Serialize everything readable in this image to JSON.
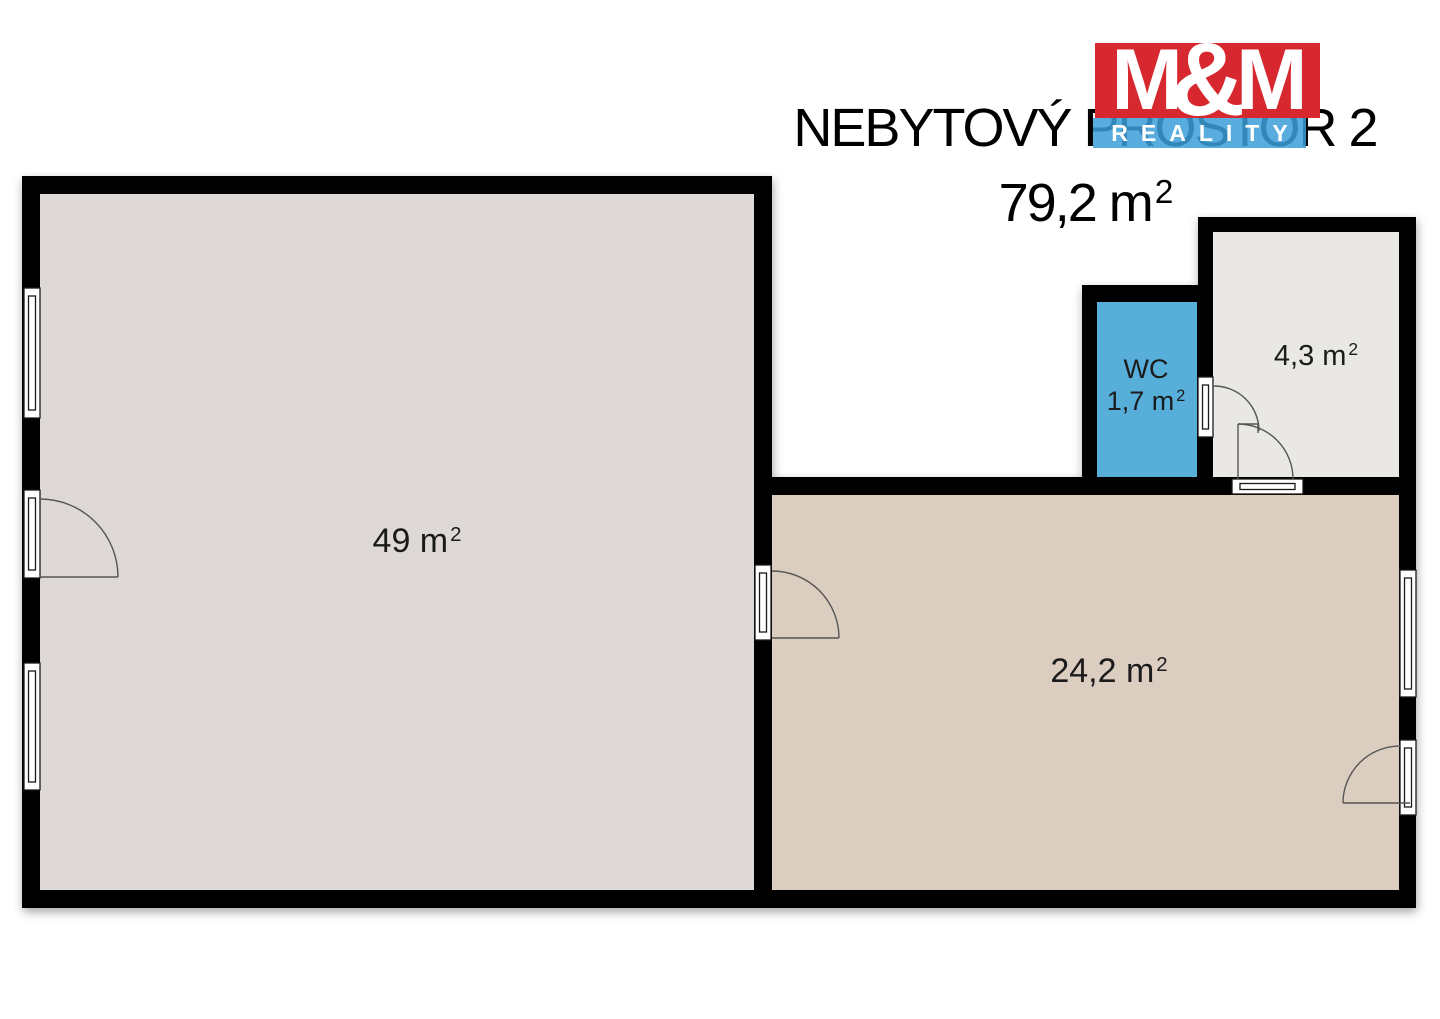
{
  "title": {
    "line1": "NEBYTOVÝ PROSTOR 2",
    "area": "79,2 m",
    "area_sup": "2"
  },
  "logo": {
    "m_left": "M",
    "ampersand": "&",
    "m_right": "M",
    "banner": "REALITY",
    "colors": {
      "red": "#d7282f",
      "blue": "#3b9fd8"
    }
  },
  "rooms": {
    "main": {
      "area": "49 m",
      "sup": "2",
      "floor_color": "#ded9d6"
    },
    "annex": {
      "area": "24,2 m",
      "sup": "2",
      "floor_color": "#dccdc1"
    },
    "small": {
      "area": "4,3 m",
      "sup": "2",
      "floor_color": "#e9e8e4"
    },
    "wc": {
      "name": "WC",
      "area": "1,7 m",
      "sup": "2",
      "floor_color": "#57aed8"
    }
  },
  "plan": {
    "wall_color": "#060606"
  }
}
